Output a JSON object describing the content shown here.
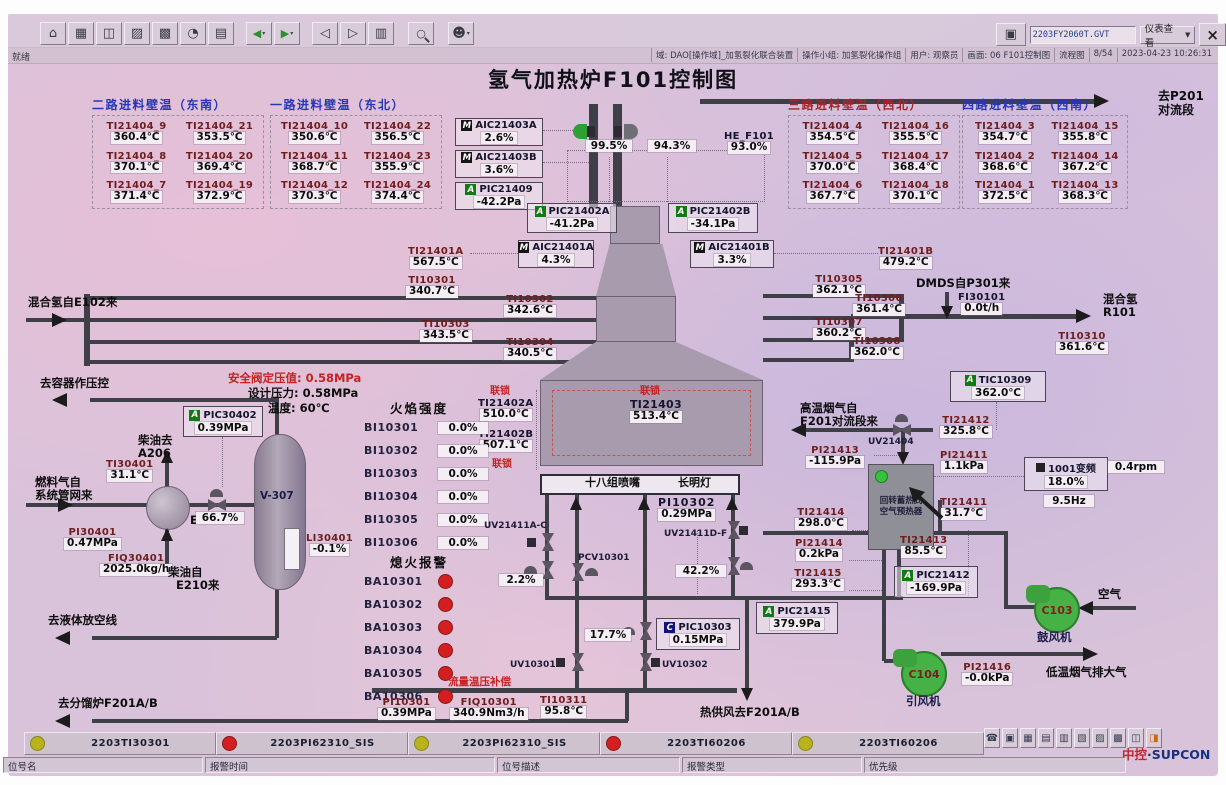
{
  "window": {
    "ready": "就绪",
    "close_glyph": "×",
    "printer_glyph": "▣",
    "screen_file": "2203FY2060T.GVT",
    "view_mode": "仪表查看",
    "dropdown_arrow": "▼",
    "status_segments": [
      "域: DAO[操作域]_加氢裂化联合装置",
      "操作小组: 加氢裂化操作组",
      "用户: 观察员",
      "画面: 06 F101控制图",
      "流程图",
      "8/54",
      "2023-04-23 10:26:31"
    ]
  },
  "toolbar_icons": [
    {
      "name": "home-icon",
      "glyph": "⌂"
    },
    {
      "name": "table-icon",
      "glyph": "▦"
    },
    {
      "name": "window-icon",
      "glyph": "◫"
    },
    {
      "name": "plant-icon",
      "glyph": "▨"
    },
    {
      "name": "grid-icon",
      "glyph": "▩"
    },
    {
      "name": "gauge-icon",
      "glyph": "◔"
    },
    {
      "name": "document-icon",
      "glyph": "▤"
    },
    {
      "name": "back-icon",
      "glyph": "◀"
    },
    {
      "name": "forward-icon",
      "glyph": "▶"
    },
    {
      "name": "page-prev-icon",
      "glyph": "◁"
    },
    {
      "name": "page-next-icon",
      "glyph": "▷"
    },
    {
      "name": "book-icon",
      "glyph": "▥"
    },
    {
      "name": "search-icon",
      "glyph": "○"
    },
    {
      "name": "user-icon",
      "glyph": "☻"
    }
  ],
  "bottom_icons": [
    {
      "name": "headset-icon",
      "glyph": "☎"
    },
    {
      "name": "unlock-icon",
      "glyph": "▣"
    },
    {
      "name": "monitor-icon",
      "glyph": "▦"
    },
    {
      "name": "save-icon",
      "glyph": "▤"
    },
    {
      "name": "calendar-icon",
      "glyph": "▥"
    },
    {
      "name": "alarm-page-icon",
      "glyph": "▧"
    },
    {
      "name": "list-icon",
      "glyph": "▨"
    },
    {
      "name": "report-icon",
      "glyph": "▩"
    },
    {
      "name": "tiles-icon",
      "glyph": "◫"
    },
    {
      "name": "horn-icon",
      "glyph": "◨"
    }
  ],
  "title": "氢气加热炉F101控制图",
  "wall_temp_groups": [
    {
      "title": "二路进料壁温（东南）",
      "cells": [
        {
          "tag": "TI21404_9",
          "value": "360.4℃"
        },
        {
          "tag": "TI21404_21",
          "value": "353.5℃"
        },
        {
          "tag": "TI21404_8",
          "value": "370.1℃"
        },
        {
          "tag": "TI21404_20",
          "value": "369.4℃"
        },
        {
          "tag": "TI21404_7",
          "value": "371.4℃"
        },
        {
          "tag": "TI21404_19",
          "value": "372.9℃"
        }
      ]
    },
    {
      "title": "一路进料壁温（东北）",
      "cells": [
        {
          "tag": "TI21404_10",
          "value": "350.6℃"
        },
        {
          "tag": "TI21404_22",
          "value": "356.5℃"
        },
        {
          "tag": "TI21404_11",
          "value": "368.7℃"
        },
        {
          "tag": "TI21404_23",
          "value": "355.9℃"
        },
        {
          "tag": "TI21404_12",
          "value": "370.3℃"
        },
        {
          "tag": "TI21404_24",
          "value": "374.4℃"
        }
      ]
    },
    {
      "title": "三路进料壁温（西北）",
      "cells": [
        {
          "tag": "TI21404_4",
          "value": "354.5℃"
        },
        {
          "tag": "TI21404_16",
          "value": "355.5℃"
        },
        {
          "tag": "TI21404_5",
          "value": "370.0℃"
        },
        {
          "tag": "TI21404_17",
          "value": "368.4℃"
        },
        {
          "tag": "TI21404_6",
          "value": "367.7℃"
        },
        {
          "tag": "TI21404_18",
          "value": "370.1℃"
        }
      ]
    },
    {
      "title": "四路进料壁温（西南）",
      "cells": [
        {
          "tag": "TI21404_3",
          "value": "354.7℃"
        },
        {
          "tag": "TI21404_15",
          "value": "355.8℃"
        },
        {
          "tag": "TI21404_2",
          "value": "368.6℃"
        },
        {
          "tag": "TI21404_14",
          "value": "367.2℃"
        },
        {
          "tag": "TI21404_1",
          "value": "372.5℃"
        },
        {
          "tag": "TI21404_13",
          "value": "368.3℃"
        }
      ]
    }
  ],
  "inst": {
    "aic21403a": {
      "tag": "AIC21403A",
      "value": "2.6%"
    },
    "aic21403b": {
      "tag": "AIC21403B",
      "value": "3.6%"
    },
    "pic21409": {
      "tag": "PIC21409",
      "value": "-42.2Pa"
    },
    "pic21402a": {
      "tag": "PIC21402A",
      "value": "-41.2Pa"
    },
    "pic21402b": {
      "tag": "PIC21402B",
      "value": "-34.1Pa"
    },
    "aic21401a": {
      "tag": "AIC21401A",
      "value": "4.3%"
    },
    "aic21401b": {
      "tag": "AIC21401B",
      "value": "3.3%"
    },
    "ti21401a": {
      "tag": "TI21401A",
      "value": "567.5℃"
    },
    "ti21401b": {
      "tag": "TI21401B",
      "value": "479.2℃"
    },
    "ti10301": {
      "tag": "TI10301",
      "value": "340.7℃"
    },
    "ti10302": {
      "tag": "TI10302",
      "value": "342.6℃"
    },
    "ti10303": {
      "tag": "TI10303",
      "value": "343.5℃"
    },
    "ti10304": {
      "tag": "TI10304",
      "value": "340.5℃"
    },
    "ti10305": {
      "tag": "TI10305",
      "value": "362.1℃"
    },
    "ti10306": {
      "tag": "TI10306",
      "value": "361.4℃"
    },
    "ti10307": {
      "tag": "TI10307",
      "value": "360.2℃"
    },
    "ti10308": {
      "tag": "TI10308",
      "value": "362.0℃"
    },
    "fi30101": {
      "tag": "FI30101",
      "value": "0.0t/h"
    },
    "ti10310": {
      "tag": "TI10310",
      "value": "361.6℃"
    },
    "tic10309": {
      "tag": "TIC10309",
      "value": "362.0℃"
    },
    "ti21402a": {
      "tag": "TI21402A",
      "value": "510.0℃"
    },
    "ti21402b": {
      "tag": "TI21402B",
      "value": "507.1℃"
    },
    "ti21403": {
      "tag": "TI21403",
      "value": "513.4℃"
    },
    "pi10302": {
      "tag": "PI10302",
      "value": "0.29MPa"
    },
    "pic10303": {
      "tag": "PIC10303",
      "value": "0.15MPa"
    },
    "pi10301": {
      "tag": "PI10301",
      "value": "0.39MPa"
    },
    "fiq10301": {
      "tag": "FIQ10301",
      "value": "340.9Nm3/h"
    },
    "ti10311": {
      "tag": "TI10311",
      "value": "95.8℃"
    },
    "pic30402": {
      "tag": "PIC30402",
      "value": "0.39MPa"
    },
    "ti30401": {
      "tag": "TI30401",
      "value": "31.1℃"
    },
    "pi30401": {
      "tag": "PI30401",
      "value": "0.47MPa"
    },
    "fiq30401": {
      "tag": "FIQ30401",
      "value": "2025.0kg/h"
    },
    "li30401": {
      "tag": "LI30401",
      "value": "-0.1%"
    },
    "ti21412": {
      "tag": "TI21412",
      "value": "325.8℃"
    },
    "pi21413": {
      "tag": "PI21413",
      "value": "-115.9Pa"
    },
    "pi21411": {
      "tag": "PI21411",
      "value": "1.1kPa"
    },
    "ti21411": {
      "tag": "TI21411",
      "value": "31.7℃"
    },
    "ti21413": {
      "tag": "TI21413",
      "value": "85.5℃"
    },
    "ti21414": {
      "tag": "TI21414",
      "value": "298.0℃"
    },
    "pi21414": {
      "tag": "PI21414",
      "value": "0.2kPa"
    },
    "ti21415": {
      "tag": "TI21415",
      "value": "293.3℃"
    },
    "pic21412": {
      "tag": "PIC21412",
      "value": "-169.9Pa"
    },
    "pic21415": {
      "tag": "PIC21415",
      "value": "379.9Pa"
    },
    "pi21416": {
      "tag": "PI21416",
      "value": "-0.0kPa"
    },
    "he_f101": {
      "tag": "HE_F101",
      "value": "93.0%"
    }
  },
  "vfd": {
    "label": "1001变频",
    "percent": "18.0%",
    "freq": "9.5Hz",
    "rpm": "0.4rpm"
  },
  "valves": {
    "stack_left": "99.5%",
    "stack_right": "94.3%",
    "fuel": "66.7%",
    "burner_a": "2.2%",
    "burner_d": "42.2%",
    "pilot": "17.7%",
    "uv21411ac": "UV21411A-C",
    "uv21411df": "UV21411D-F",
    "pcv10301": "PCV10301",
    "uv10301": "UV10301",
    "uv10302": "UV10302",
    "uv21404": "UV21404"
  },
  "flame": {
    "title": "火焰强度",
    "rows": [
      {
        "tag": "BI10301",
        "value": "0.0%"
      },
      {
        "tag": "BI10302",
        "value": "0.0%"
      },
      {
        "tag": "BI10303",
        "value": "0.0%"
      },
      {
        "tag": "BI10304",
        "value": "0.0%"
      },
      {
        "tag": "BI10305",
        "value": "0.0%"
      },
      {
        "tag": "BI10306",
        "value": "0.0%"
      }
    ]
  },
  "flameout": {
    "title": "熄火报警",
    "rows": [
      {
        "tag": "BA10301"
      },
      {
        "tag": "BA10302"
      },
      {
        "tag": "BA10303"
      },
      {
        "tag": "BA10304"
      },
      {
        "tag": "BA10305"
      },
      {
        "tag": "BA10306"
      }
    ]
  },
  "labels": {
    "to_p201_1": "去P201",
    "to_p201_2": "对流段",
    "h2_in": "混合氢自E102来",
    "dmds": "DMDS自P301来",
    "h2_out_1": "混合氢",
    "h2_out_2": "R101",
    "interlock": "联锁",
    "to_vessel": "去容器作压控",
    "psv": "安全阀定压值: 0.58MPa",
    "design_p": "设计压力: 0.58MPa",
    "design_t": "温度: 60℃",
    "diesel_to_1": "柴油去",
    "diesel_to_2": "A206",
    "fuel_in_1": "燃料气自",
    "fuel_in_2": "系统管网来",
    "e217": "E217",
    "v307": "V-307",
    "diesel_from_1": "柴油自",
    "diesel_from_2": "E210来",
    "to_vent": "去液体放空线",
    "to_f201": "去分馏炉F201A/B",
    "compensation": "流量温压补偿",
    "hot_air": "热供风去F201A/B",
    "burner_nozzles": "十八组喷嘴",
    "pilot_lamp": "长明灯",
    "flue_in_1": "高温烟气自",
    "flue_in_2": "F201对流段来",
    "preheater_1": "回转蓄热式",
    "preheater_2": "空气预热器",
    "air": "空气",
    "flue_out": "低温烟气排大气",
    "c103": "C103",
    "c103_name": "鼓风机",
    "c104": "C104",
    "c104_name": "引风机"
  },
  "alarm_bar": {
    "entries": [
      {
        "color": "yellow",
        "tag": "2203TI30301"
      },
      {
        "color": "red",
        "tag": "2203PI62310_SIS"
      },
      {
        "color": "yellow",
        "tag": "2203PI62310_SIS"
      },
      {
        "color": "red",
        "tag": "2203TI60206"
      },
      {
        "color": "yellow",
        "tag": "2203TI60206"
      }
    ],
    "fields": [
      "位号名",
      "报警时间",
      "位号描述",
      "报警类型",
      "优先级"
    ],
    "logo_cn": "中控",
    "logo_en": "·SUPCON"
  }
}
